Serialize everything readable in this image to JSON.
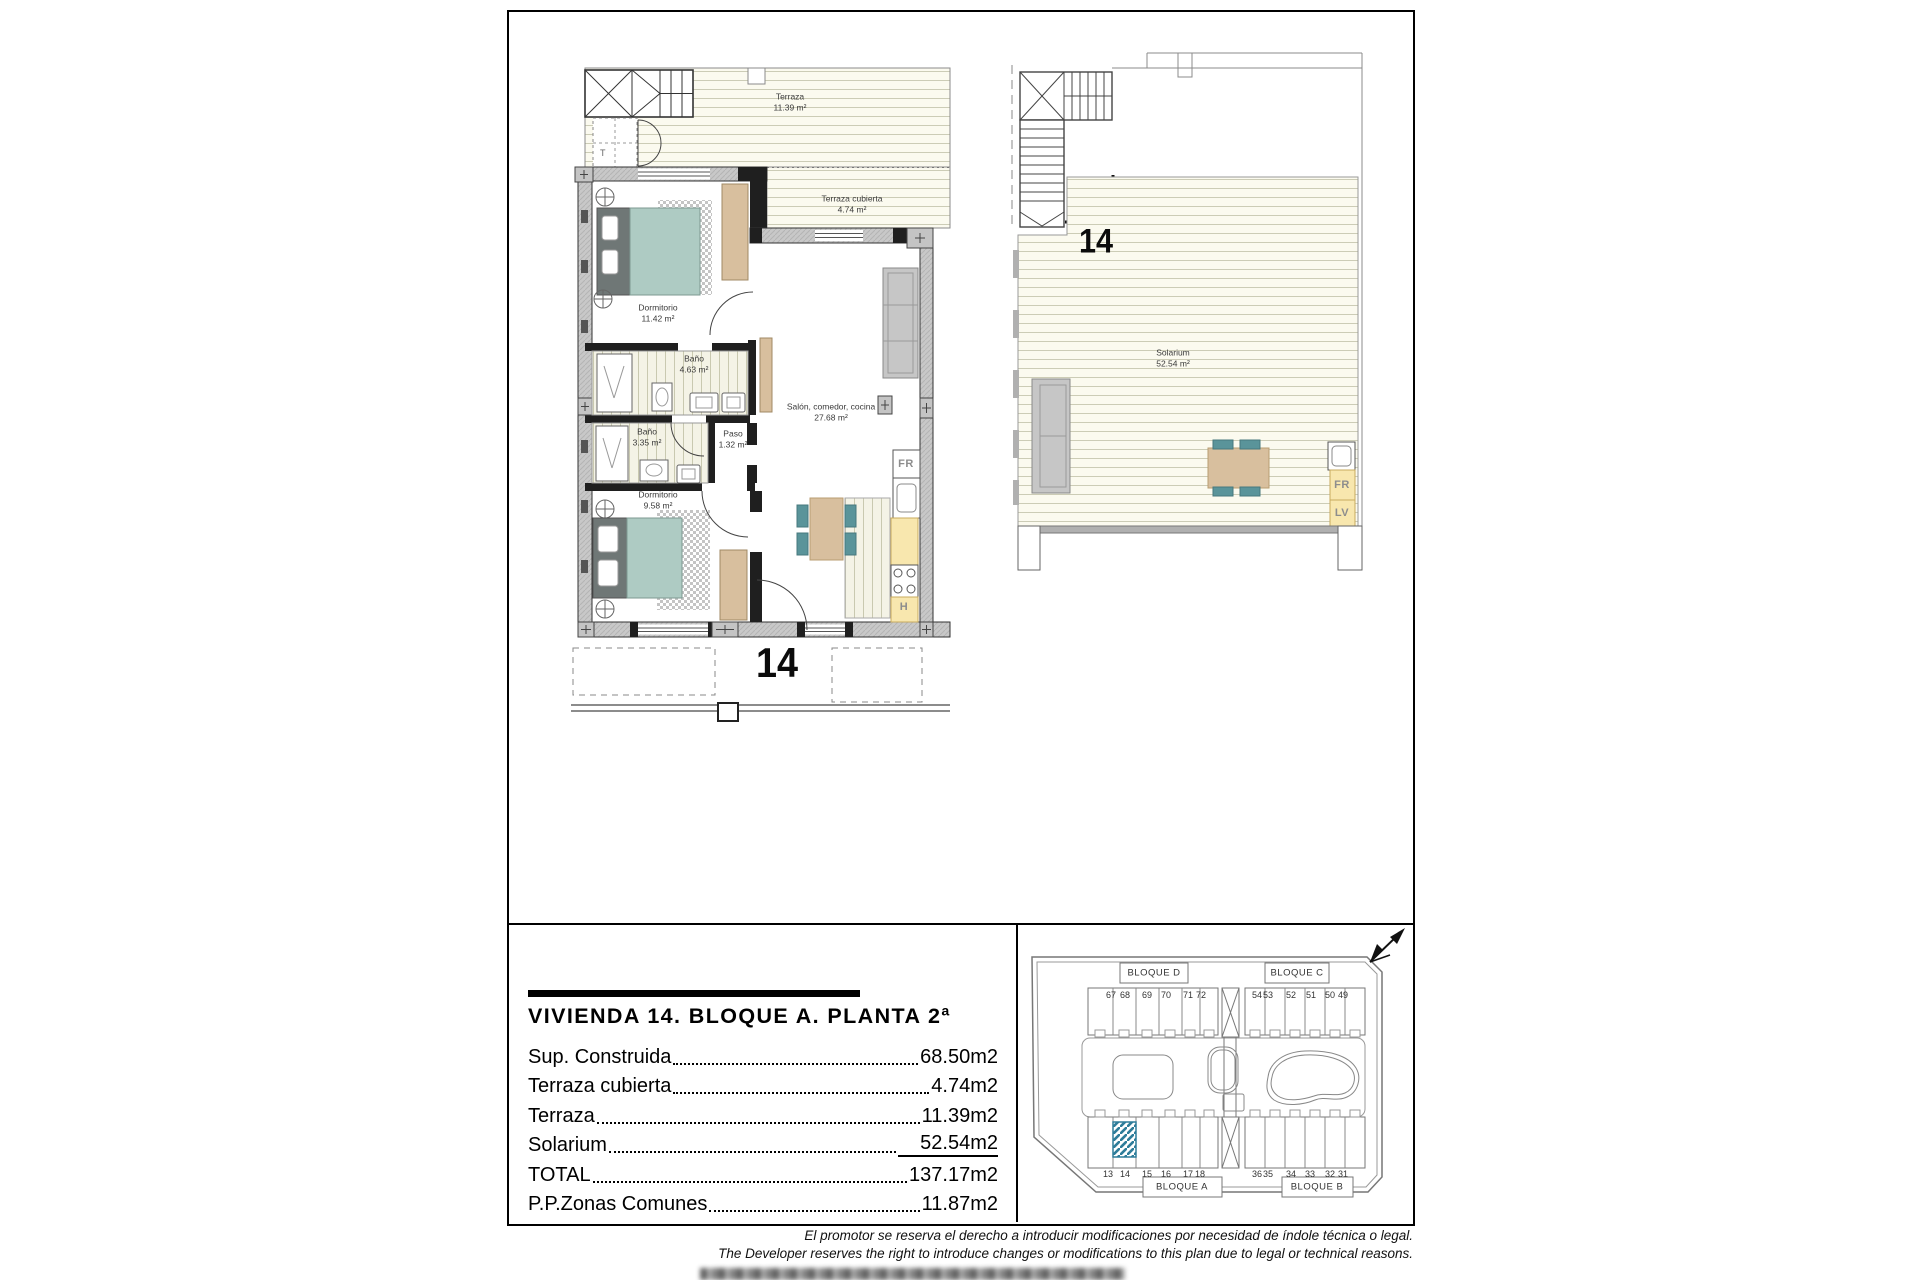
{
  "plan_main": {
    "unit_label": "14",
    "terraza": {
      "name": "Terraza",
      "area": "11.39 m²"
    },
    "terraza_cubierta": {
      "name": "Terraza cubierta",
      "area": "4.74 m²"
    },
    "dormitorio_1": {
      "name": "Dormitorio",
      "area": "11.42 m²"
    },
    "bano_1": {
      "name": "Baño",
      "area": "4.63 m²"
    },
    "bano_2": {
      "name": "Baño",
      "area": "3.35 m²"
    },
    "paso": {
      "name": "Paso",
      "area": "1.32 m²"
    },
    "dormitorio_2": {
      "name": "Dormitorio",
      "area": "9.58 m²"
    },
    "salon": {
      "name": "Salón, comedor, cocina",
      "area": "27.68 m²"
    },
    "tag_fr": "FR",
    "tag_h": "H",
    "tag_t": "T"
  },
  "plan_solarium": {
    "unit_label": "14",
    "solarium": {
      "name": "Solarium",
      "area": "52.54 m²"
    },
    "tag_fr": "FR",
    "tag_lv": "LV"
  },
  "summary": {
    "title": "VIVIENDA 14. BLOQUE A. PLANTA 2ª",
    "rows": [
      {
        "label": "Sup. Construida",
        "value": "68.50m2"
      },
      {
        "label": "Terraza cubierta",
        "value": "4.74m2"
      },
      {
        "label": "Terraza",
        "value": "11.39m2"
      },
      {
        "label": "Solarium",
        "value": "52.54m2"
      },
      {
        "label": "TOTAL",
        "value": "137.17m2"
      },
      {
        "label": "P.P.Zonas Comunes",
        "value": "11.87m2"
      }
    ]
  },
  "site_plan": {
    "block_d": {
      "label": "BLOQUE D",
      "units": [
        "67",
        "68",
        "69",
        "70",
        "71",
        "72"
      ]
    },
    "block_c": {
      "label": "BLOQUE C",
      "units": [
        "54",
        "53",
        "52",
        "51",
        "50",
        "49"
      ]
    },
    "block_a": {
      "label": "BLOQUE A",
      "units": [
        "13",
        "14",
        "15",
        "16",
        "17",
        "18"
      ]
    },
    "block_b": {
      "label": "BLOQUE B",
      "units": [
        "36",
        "35",
        "34",
        "33",
        "32",
        "31"
      ]
    },
    "highlighted_unit": "14"
  },
  "disclaimer": {
    "es": "El promotor se reserva el derecho a introducir modificaciones por necesidad de índole técnica o legal.",
    "en": "The Developer reserves the right to introduce changes or modifications to this plan due to legal or technical reasons."
  },
  "colors": {
    "accent_teal": "#5a949a",
    "furniture_tan": "#d8bf9e",
    "deck_cream": "#fbfaef",
    "kitchen_yellow": "#f8e7ae",
    "highlight_blue": "#2e7d9a"
  }
}
